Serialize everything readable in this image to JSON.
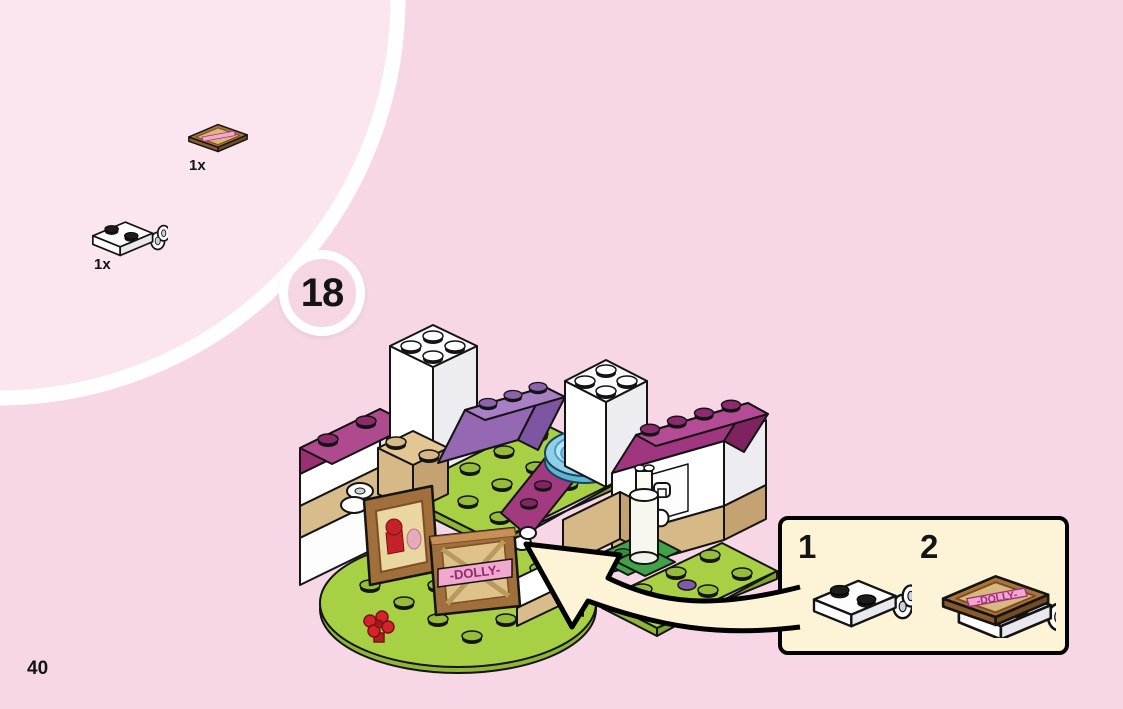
{
  "page": {
    "number": "40"
  },
  "step": {
    "number": "18"
  },
  "parts_list": {
    "items": [
      {
        "qty": "1x",
        "piece": "brown-square-tile-with-dolly-sign"
      },
      {
        "qty": "1x",
        "piece": "white-1x2-plate-with-clips"
      }
    ]
  },
  "inset": {
    "steps": [
      {
        "number": "1",
        "piece": "white-1x2-plate-with-clips"
      },
      {
        "number": "2",
        "piece": "dolly-sign-tile-on-clip-plate"
      }
    ]
  },
  "build": {
    "sign_text": "-DOLLY-"
  },
  "colors": {
    "background": "#f7d7e5",
    "parts_area_background": "#fbe6f0",
    "divider": "#ffffff",
    "callout_fill": "#fdf3d7",
    "outline": "#000000",
    "lime_green": "#a8d044",
    "dark_green": "#41a24a",
    "magenta": "#a03680",
    "lavender": "#9468b3",
    "tan": "#d6b987",
    "brown": "#a06f3c",
    "banner_pink": "#f2a7ce",
    "trans_blue": "#8fd0e8",
    "red": "#c4222a"
  }
}
